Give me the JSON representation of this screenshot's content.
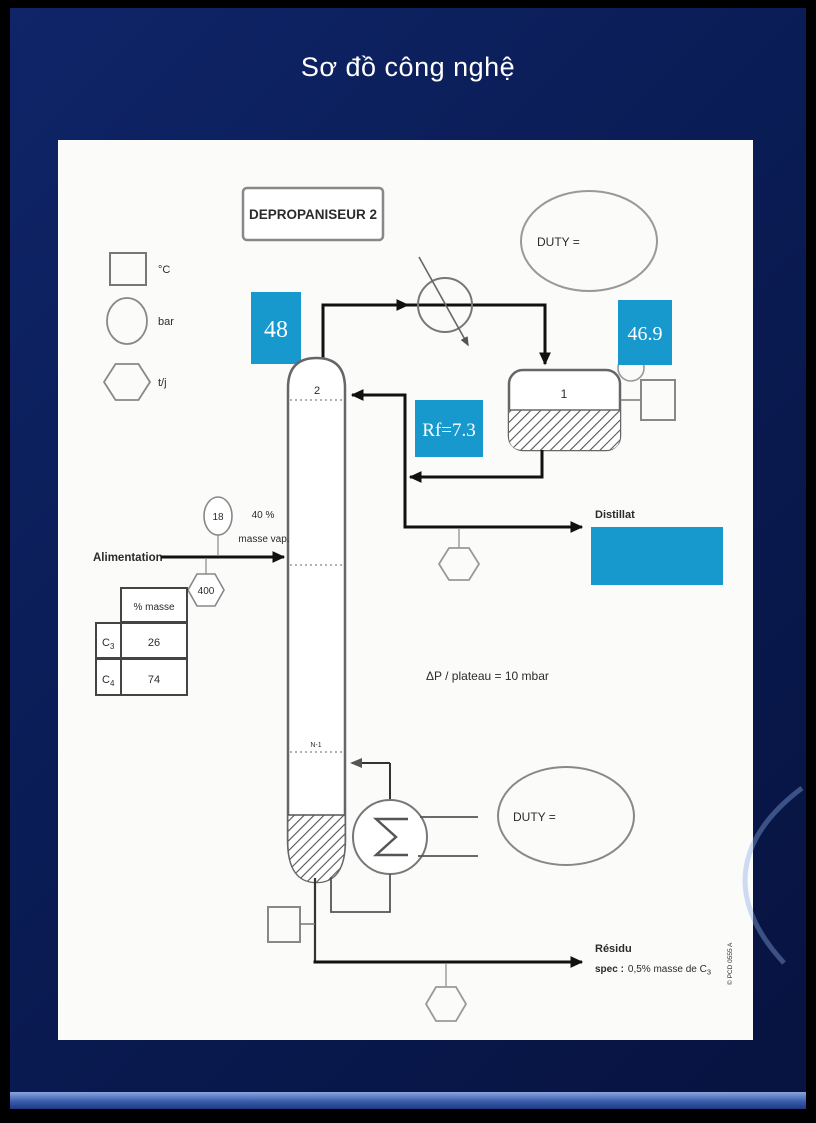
{
  "slide": {
    "title": "Sơ đồ công nghệ"
  },
  "colors": {
    "highlight": "#1899cd"
  },
  "diagram": {
    "unit_title": "DEPROPANISEUR 2",
    "legend": {
      "temp": "°C",
      "pressure": "bar",
      "flow": "t/j"
    },
    "overhead_temp": "48",
    "drum_temp": "46.9",
    "reflux_ratio": "Rf=7.3",
    "condenser_duty": "DUTY =",
    "reboiler_duty": "DUTY =",
    "tray_top": "2",
    "tray_bottom": "N-1",
    "drum_tag": "1",
    "feed": {
      "label": "Alimentation",
      "pressure": "18",
      "vapor_line1": "40 %",
      "vapor_line2": "masse vap.",
      "flow": "400"
    },
    "feed_table": {
      "header": "% masse",
      "row1_name": "C",
      "row1_sub": "3",
      "row1_value": "26",
      "row2_name": "C",
      "row2_sub": "4",
      "row2_value": "74"
    },
    "plate_dp": "ΔP / plateau = 10 mbar",
    "distillate_label": "Distillat",
    "residue": {
      "label": "Résidu",
      "spec_bold": "spec :",
      "spec_rest": "0,5% masse de C",
      "spec_sub": "3"
    },
    "credit": "© PCD 0555 A"
  }
}
